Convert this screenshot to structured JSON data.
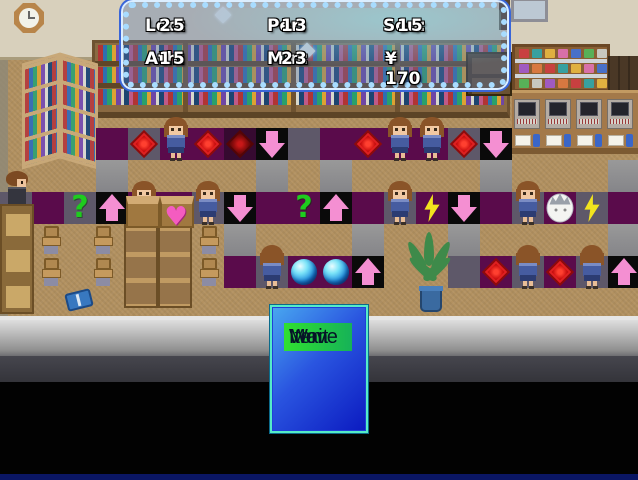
{
  "status": {
    "loo_label": "Loo:",
    "loo_value": "25",
    "per_label": "Per:",
    "per_value": "13",
    "sou_label": "Sou:",
    "sou_value": "15",
    "ath_label": "Ath:",
    "ath_value": "15",
    "min_label": "Min:",
    "min_value": "23",
    "money": "¥ 170"
  },
  "menu": {
    "items": [
      {
        "label": "Move",
        "selected": true
      },
      {
        "label": "Wait",
        "selected": false
      },
      {
        "label": "Item",
        "selected": false
      }
    ]
  },
  "colors": {
    "tile_maroon": "#5a0b4b",
    "tile_slate": "#5e5869",
    "tile_black": "#0a0a0a",
    "path_gray": "#8f8f8f",
    "arrow_pink": "#f48fd2",
    "diamond_red": "#cc1010",
    "question_green": "#1ecc1e",
    "bolt_yellow": "#f2e41e",
    "orb_blue": "#1e8ce0",
    "menu_highlight_green": "#30e030",
    "menu_blue": "#2a55e0",
    "window_border_blue": "#a8dcff"
  },
  "board": {
    "tile_size": 32,
    "icon_legend": {
      "diamond": "red-diamond-icon",
      "diamond-dark": "dark-red-diamond-icon",
      "arrow-up": "pink-up-arrow-icon",
      "arrow-down": "pink-down-arrow-icon",
      "question": "green-question-icon",
      "bolt": "lightning-bolt-icon",
      "orb": "blue-orb-icon",
      "face": "white-face-icon",
      "heart": "pink-heart-icon"
    },
    "tiles": [
      {
        "x": 96,
        "y": 160,
        "t": "path"
      },
      {
        "x": 256,
        "y": 160,
        "t": "path"
      },
      {
        "x": 320,
        "y": 160,
        "t": "path"
      },
      {
        "x": 480,
        "y": 160,
        "t": "path"
      },
      {
        "x": 608,
        "y": 160,
        "t": "path"
      },
      {
        "x": 224,
        "y": 224,
        "t": "path"
      },
      {
        "x": 352,
        "y": 224,
        "t": "path"
      },
      {
        "x": 448,
        "y": 224,
        "t": "path"
      },
      {
        "x": 608,
        "y": 224,
        "t": "path"
      },
      {
        "x": 96,
        "y": 128,
        "t": "maroon"
      },
      {
        "x": 128,
        "y": 128,
        "t": "slate",
        "icon": "diamond"
      },
      {
        "x": 160,
        "y": 128,
        "t": "maroon"
      },
      {
        "x": 192,
        "y": 128,
        "t": "maroon",
        "icon": "diamond"
      },
      {
        "x": 224,
        "y": 128,
        "t": "darkmaroon",
        "icon": "diamond-dark"
      },
      {
        "x": 256,
        "y": 128,
        "t": "black",
        "icon": "arrow-down"
      },
      {
        "x": 288,
        "y": 128,
        "t": "slate"
      },
      {
        "x": 320,
        "y": 128,
        "t": "maroon"
      },
      {
        "x": 352,
        "y": 128,
        "t": "maroon",
        "icon": "diamond"
      },
      {
        "x": 384,
        "y": 128,
        "t": "maroon"
      },
      {
        "x": 416,
        "y": 128,
        "t": "maroon"
      },
      {
        "x": 448,
        "y": 128,
        "t": "slate",
        "icon": "diamond"
      },
      {
        "x": 480,
        "y": 128,
        "t": "black",
        "icon": "arrow-down"
      },
      {
        "x": 0,
        "y": 192,
        "t": "slate"
      },
      {
        "x": 32,
        "y": 192,
        "t": "maroon"
      },
      {
        "x": 64,
        "y": 192,
        "t": "slate",
        "icon": "question"
      },
      {
        "x": 96,
        "y": 192,
        "t": "black",
        "icon": "arrow-up"
      },
      {
        "x": 128,
        "y": 192,
        "t": "maroon"
      },
      {
        "x": 160,
        "y": 192,
        "t": "maroon"
      },
      {
        "x": 192,
        "y": 192,
        "t": "slate"
      },
      {
        "x": 224,
        "y": 192,
        "t": "black",
        "icon": "arrow-down"
      },
      {
        "x": 256,
        "y": 192,
        "t": "maroon"
      },
      {
        "x": 288,
        "y": 192,
        "t": "maroon",
        "icon": "question"
      },
      {
        "x": 320,
        "y": 192,
        "t": "black",
        "icon": "arrow-up"
      },
      {
        "x": 352,
        "y": 192,
        "t": "maroon"
      },
      {
        "x": 384,
        "y": 192,
        "t": "slate"
      },
      {
        "x": 416,
        "y": 192,
        "t": "maroon",
        "icon": "bolt"
      },
      {
        "x": 448,
        "y": 192,
        "t": "black",
        "icon": "arrow-down"
      },
      {
        "x": 480,
        "y": 192,
        "t": "maroon"
      },
      {
        "x": 512,
        "y": 192,
        "t": "slate"
      },
      {
        "x": 544,
        "y": 192,
        "t": "maroon",
        "icon": "face"
      },
      {
        "x": 576,
        "y": 192,
        "t": "slate",
        "icon": "bolt"
      },
      {
        "x": 608,
        "y": 192,
        "t": "maroon"
      },
      {
        "x": 224,
        "y": 256,
        "t": "maroon"
      },
      {
        "x": 256,
        "y": 256,
        "t": "slate"
      },
      {
        "x": 288,
        "y": 256,
        "t": "maroon",
        "icon": "orb"
      },
      {
        "x": 320,
        "y": 256,
        "t": "maroon",
        "icon": "orb"
      },
      {
        "x": 352,
        "y": 256,
        "t": "black",
        "icon": "arrow-up"
      },
      {
        "x": 448,
        "y": 256,
        "t": "slate"
      },
      {
        "x": 480,
        "y": 256,
        "t": "maroon",
        "icon": "diamond"
      },
      {
        "x": 512,
        "y": 256,
        "t": "slate"
      },
      {
        "x": 544,
        "y": 256,
        "t": "maroon",
        "icon": "diamond"
      },
      {
        "x": 576,
        "y": 256,
        "t": "slate"
      },
      {
        "x": 608,
        "y": 256,
        "t": "black",
        "icon": "arrow-up"
      }
    ],
    "loose_icons": [
      {
        "icon": "heart",
        "x": 160,
        "y": 205
      }
    ]
  },
  "sprites": {
    "girls_front": [
      {
        "x": 164,
        "y": 117
      },
      {
        "x": 388,
        "y": 117
      },
      {
        "x": 420,
        "y": 117
      },
      {
        "x": 132,
        "y": 181
      },
      {
        "x": 196,
        "y": 181
      },
      {
        "x": 388,
        "y": 181
      },
      {
        "x": 516,
        "y": 181
      }
    ],
    "girls_back": [
      {
        "x": 260,
        "y": 245
      },
      {
        "x": 516,
        "y": 245
      },
      {
        "x": 580,
        "y": 245
      }
    ],
    "man": {
      "x": 5,
      "y": 171
    }
  }
}
